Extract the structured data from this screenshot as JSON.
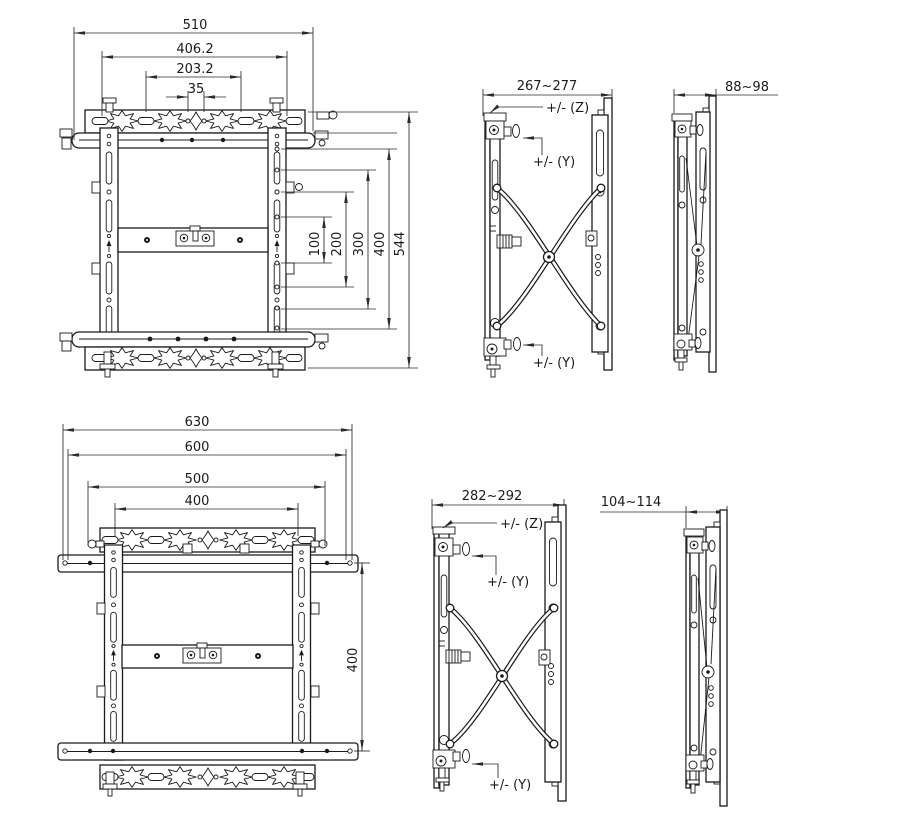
{
  "colors": {
    "background": "#ffffff",
    "line": "#1a1a1a",
    "dimension": "#2a2a2a"
  },
  "views": {
    "front_top": {
      "dims_horizontal": [
        "510",
        "406.2",
        "203.2",
        "35"
      ],
      "dims_vertical": [
        "100",
        "200",
        "300",
        "400",
        "544"
      ]
    },
    "side_extended_top": {
      "dim_width": "267~277",
      "label_z": "+/- (Z)",
      "label_y_top": "+/- (Y)",
      "label_y_bottom": "+/- (Y)"
    },
    "side_folded_top": {
      "dim_width": "88~98"
    },
    "front_bottom": {
      "dims_horizontal": [
        "630",
        "600",
        "500",
        "400"
      ],
      "dims_vertical": [
        "400"
      ]
    },
    "side_extended_bottom": {
      "dim_width": "282~292",
      "label_z": "+/- (Z)",
      "label_y_top": "+/- (Y)",
      "label_y_bottom": "+/- (Y)"
    },
    "side_folded_bottom": {
      "dim_width": "104~114"
    }
  }
}
